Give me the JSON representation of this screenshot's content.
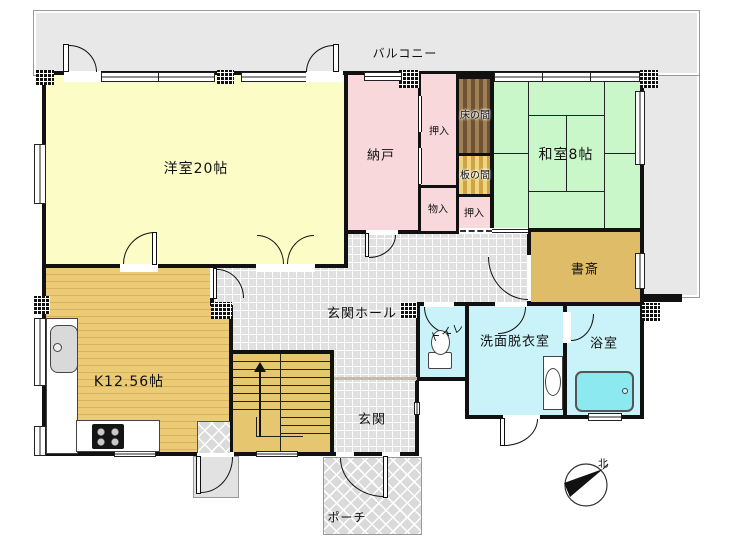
{
  "plan": {
    "labels": {
      "balcony": "バルコニー",
      "western_room": "洋室20帖",
      "storage_room": "納戸",
      "closet_top": "押入",
      "tokonoma": "床の間",
      "japanese_room": "和室8帖",
      "itanoma": "板の間",
      "closet_bottom": "押入",
      "storage_small": "物入",
      "study": "書斎",
      "entrance_hall": "玄関ホール",
      "toilet": "トイレ",
      "washroom": "洗面脱衣室",
      "bathroom": "浴室",
      "kitchen": "K12.56帖",
      "entrance": "玄関",
      "porch": "ポーチ"
    },
    "compass": {
      "north": "北"
    },
    "colors": {
      "western_room": "#FCFCC6",
      "storage_pink": "#F8D8DB",
      "tatami_green": "#C9F7C9",
      "study_tan": "#DEBC68",
      "kitchen_floor": "#EBCB76",
      "stairs": "#E6C770",
      "wet_area_cyan": "#C9F3F8",
      "hall_tile": "#E0E0E0",
      "balcony_gray": "#E8E8E8",
      "tokonoma_brown": "#6E5233",
      "wall": "#111111"
    }
  }
}
